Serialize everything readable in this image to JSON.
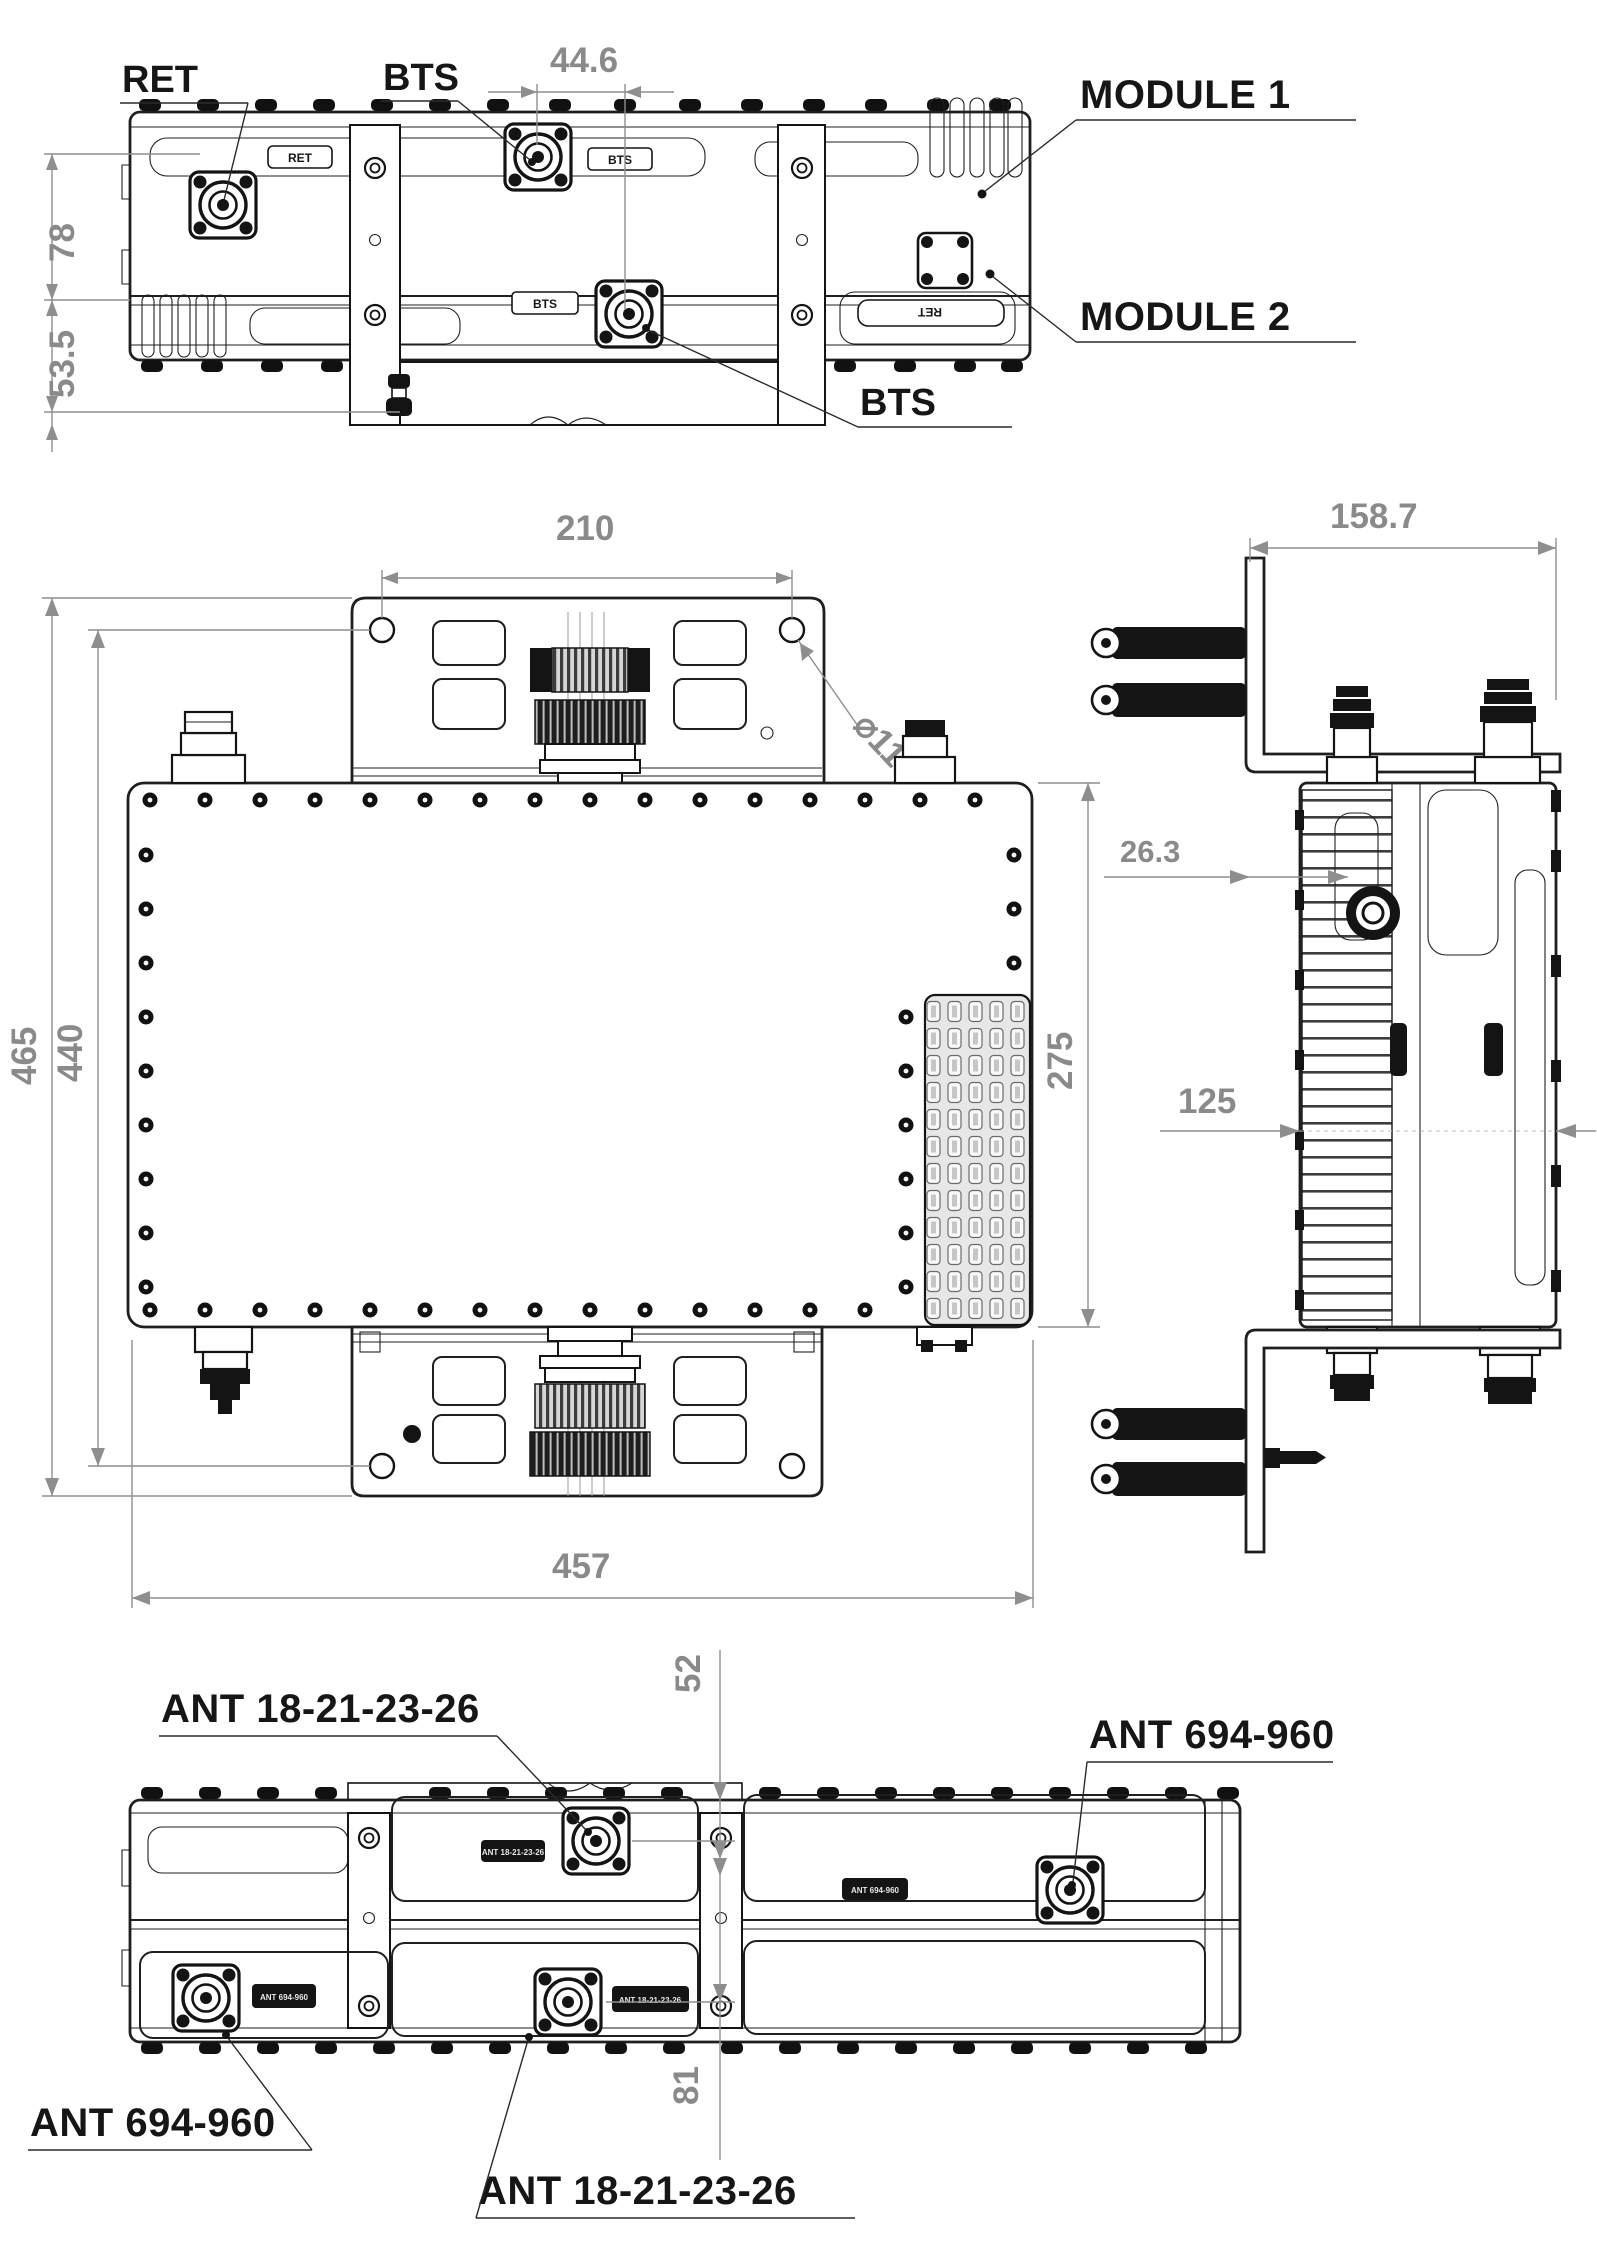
{
  "top_view": {
    "callouts": {
      "ret": "RET",
      "bts_upper": "BTS",
      "module1": "MODULE 1",
      "module2": "MODULE 2",
      "bts_lower": "BTS"
    },
    "dimensions": {
      "bts_center_offset": "44.6",
      "module1_height": "78",
      "module2_height": "53.5"
    },
    "engraved": {
      "ret_left": "RET",
      "bts_upper": "BTS",
      "bts_lower": "BTS",
      "ret_right": "RET"
    }
  },
  "front_view": {
    "dimensions": {
      "bracket_hole_spacing": "210",
      "bracket_hole_diameter": "⌀11",
      "overall_height": "465",
      "mounting_hole_span": "440",
      "body_height": "275",
      "body_width": "457"
    }
  },
  "side_view": {
    "dimensions": {
      "overall_depth": "158.7",
      "port_offset": "26.3",
      "body_depth": "125"
    }
  },
  "bottom_view": {
    "callouts": {
      "ant_high_upper": "ANT 18-21-23-26",
      "ant_low_right": "ANT 694-960",
      "ant_low_left": "ANT 694-960",
      "ant_high_lower": "ANT 18-21-23-26"
    },
    "dimensions": {
      "upper_port_offset": "52",
      "port_row_spacing": "81"
    },
    "engraved": {
      "upper_mid": "ANT 18-21-23-26",
      "right": "ANT 694-960",
      "lower_left": "ANT 694-960",
      "lower_mid": "ANT 18-21-23-26"
    }
  }
}
